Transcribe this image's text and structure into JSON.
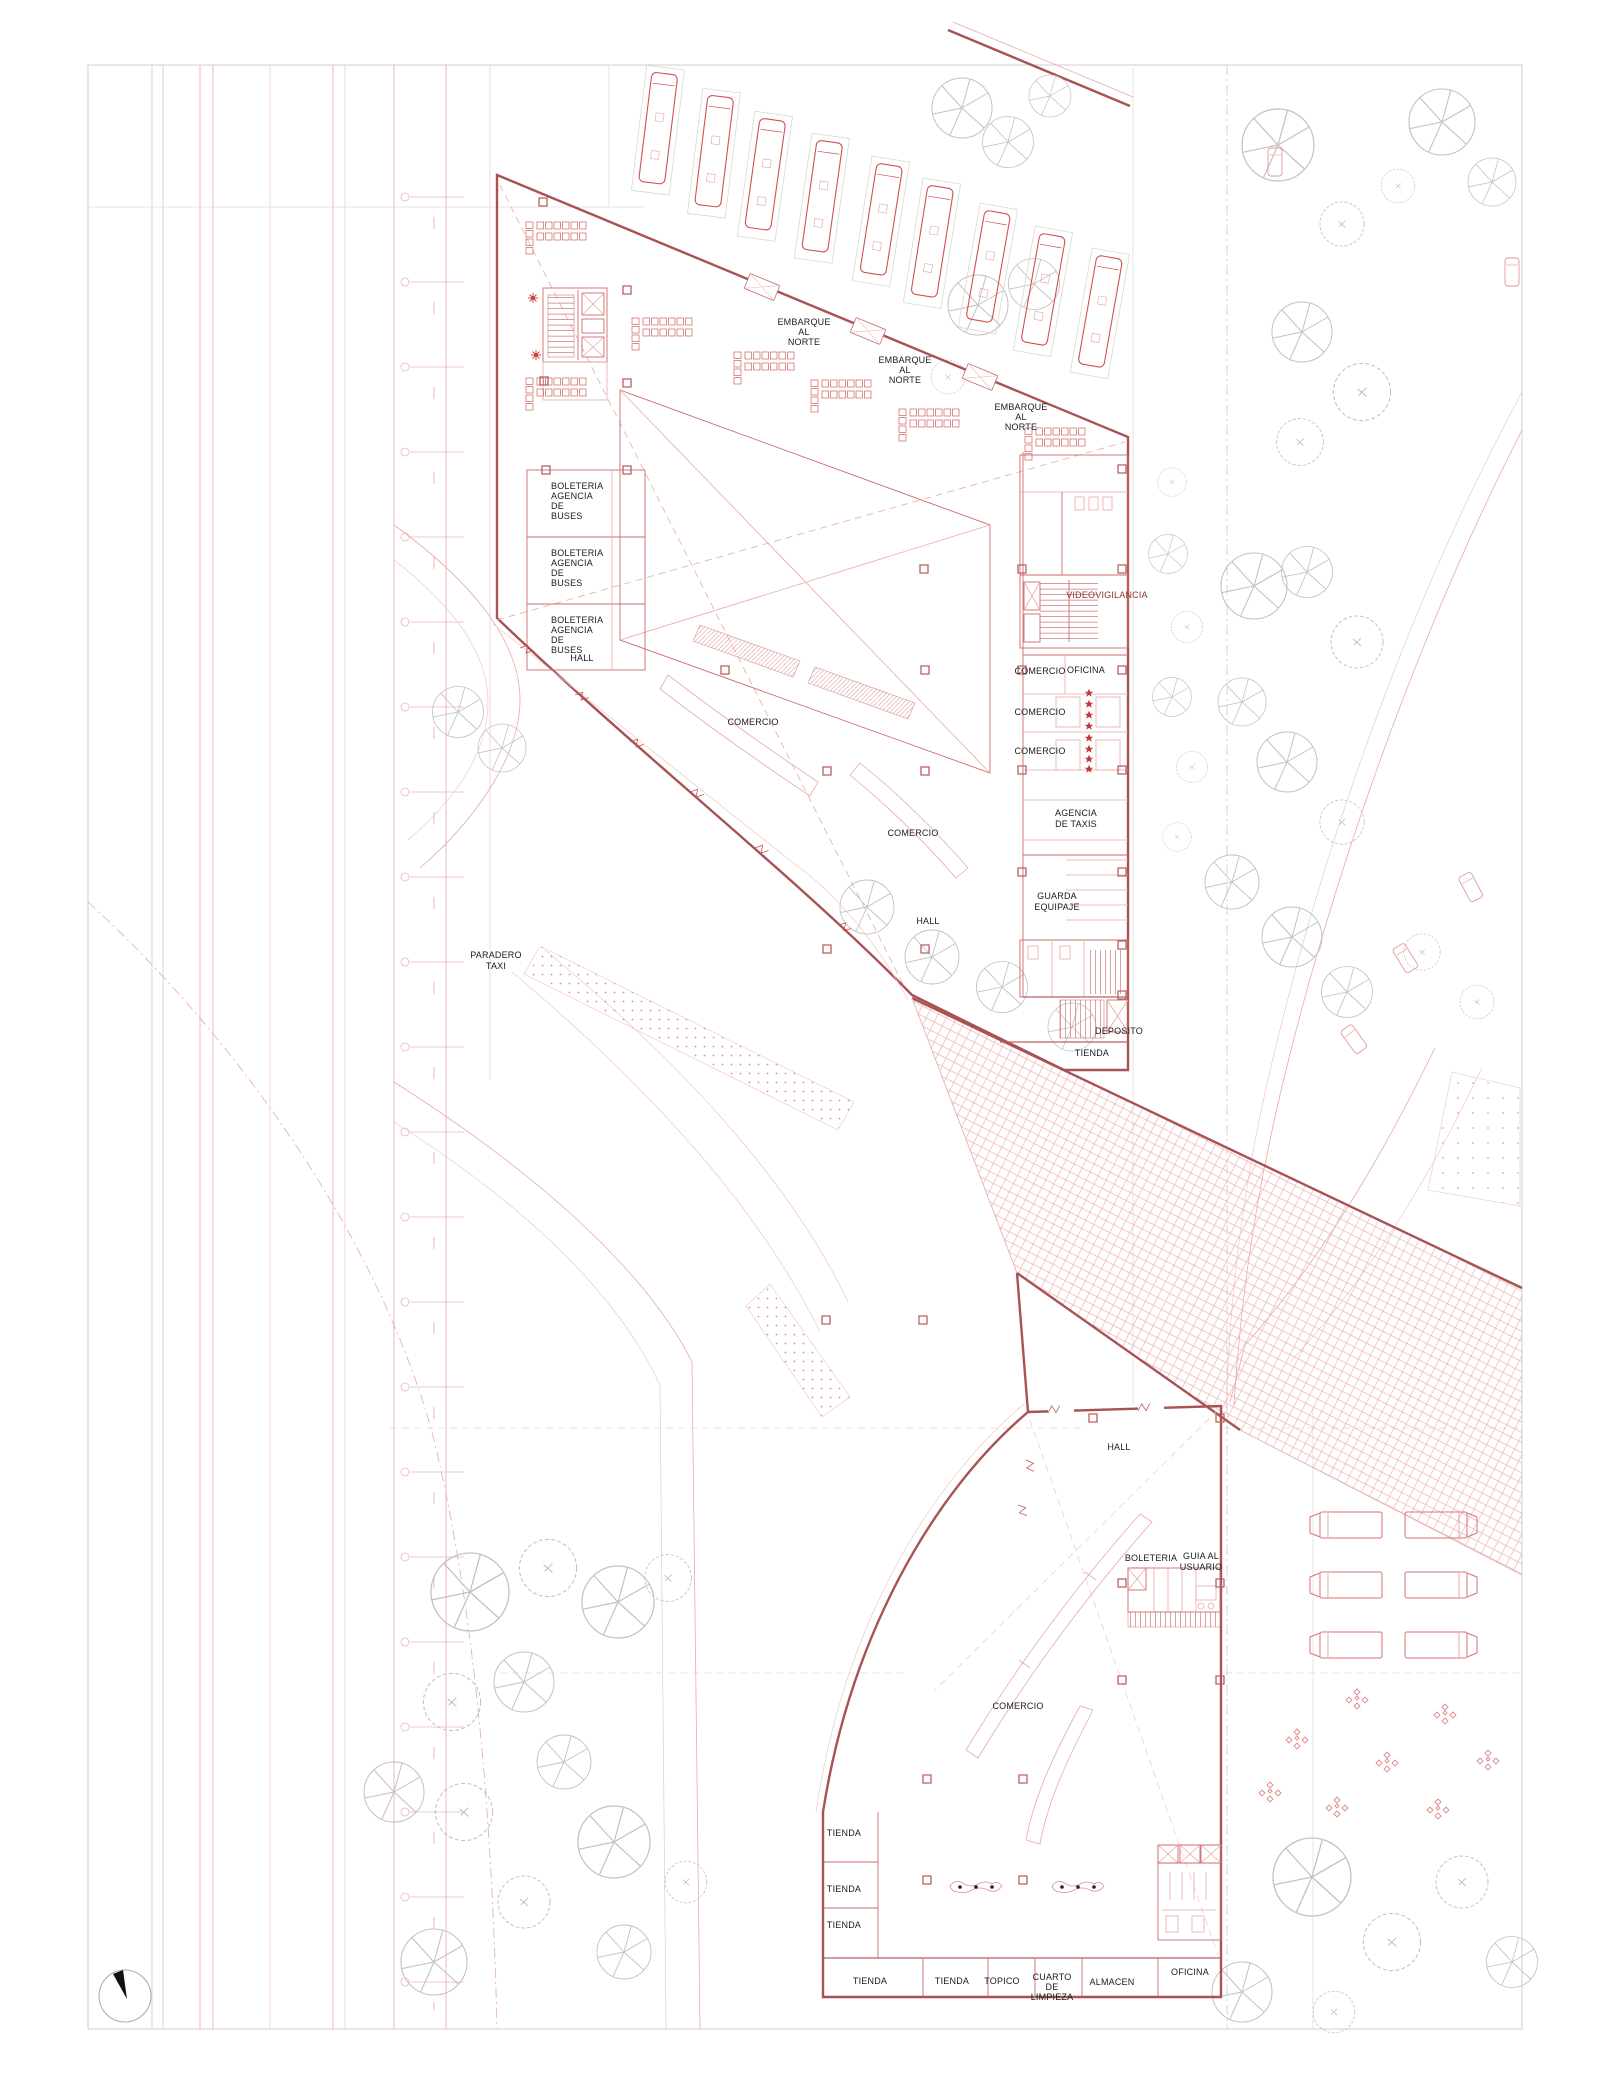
{
  "document": {
    "type": "architectural-site-plan",
    "subject": "bus terminal ground floor plan",
    "language": "es"
  },
  "colors": {
    "background": "#ffffff",
    "wall_dark_red": "#a85252",
    "line_red": "#cf6a6a",
    "line_light_red": "#e9a8a8",
    "tree_gray": "#c2c2c2",
    "text_black": "#1b1b1b",
    "text_dark_red": "#8a3434",
    "star_red": "#c03a3a"
  },
  "labels": {
    "embarque_norte": [
      "EMBARQUE",
      "AL",
      "NORTE"
    ],
    "boleteria_agencia_buses": [
      "BOLETERIA",
      "AGENCIA",
      "DE",
      "BUSES"
    ],
    "hall": "HALL",
    "comercio": "COMERCIO",
    "videovigilancia": "VIDEOVIGILANCIA",
    "oficina": "OFICINA",
    "agencia_taxis": [
      "AGENCIA",
      "DE TAXIS"
    ],
    "guarda_equipaje": [
      "GUARDA",
      "EQUIPAJE"
    ],
    "deposito": "DEPOSITO",
    "tienda": "TIENDA",
    "paradero_taxi": [
      "PARADERO",
      "TAXI"
    ],
    "boleteria": "BOLETERIA",
    "guia_usuario": [
      "GUIA AL",
      "USUARIO"
    ],
    "topico": "TOPICO",
    "cuarto_limpieza": [
      "CUARTO",
      "DE",
      "LIMPIEZA"
    ],
    "almacen": "ALMACEN"
  }
}
